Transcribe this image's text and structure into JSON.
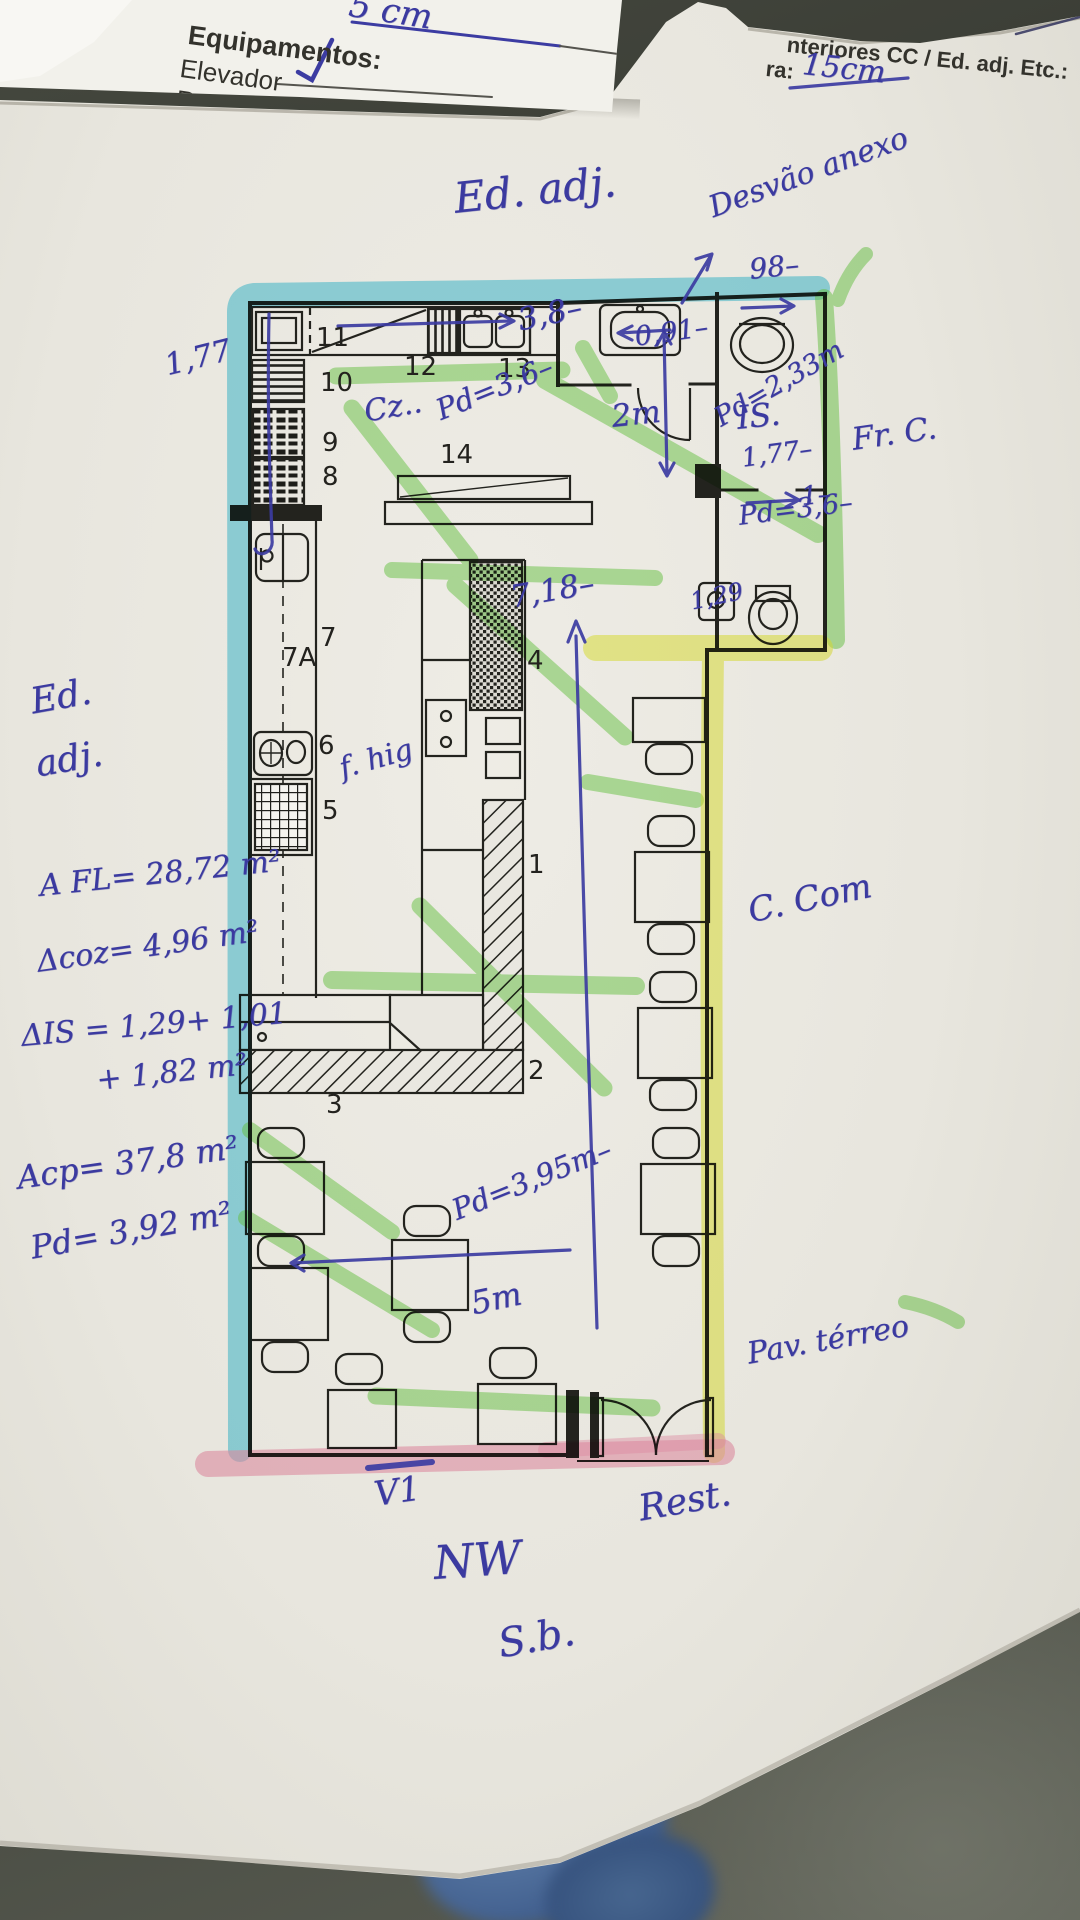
{
  "form_sheet": {
    "fragment_cm": "5 cm",
    "equipment_header": "Equipamentos:",
    "item_elevador": "Elevador",
    "item_rede": "Rede de Gá"
  },
  "plan_header": {
    "interiores_label": "nteriores CC / Ed. adj. Etc.:",
    "ra_label": "ra:",
    "ra_value": "15cm"
  },
  "plan_numbers": {
    "n1": "1",
    "n2": "2",
    "n3": "3",
    "n4": "4",
    "n5": "5",
    "n6": "6",
    "n7": "7",
    "n7a": "7A",
    "n8": "8",
    "n9": "9",
    "n10": "10",
    "n11": "11",
    "n12": "12",
    "n13": "13",
    "n14": "14"
  },
  "annotations": {
    "ed_adj_top": "Ed. adj.",
    "desvao_anexo": "Desvão anexo",
    "dim_3_8": "3,8–",
    "dim_0_91": "0,91–",
    "dim_98": "98–",
    "pd_2_33": "Pd=2,33m",
    "is_label": "IS.",
    "dim_1_77_right": "1,77–",
    "dim_2m": "2m",
    "dim_1": "1–",
    "pd_3_6_right": "Pd=3,6–",
    "dim_1_29": "1,29",
    "fr_c": "Fr. C.",
    "cz": "Cz..",
    "pd_3_6_kitchen": "Pd=3,6–",
    "dim_1_77_left": "1,77",
    "dim_7_18": "7,18–",
    "f_hig": "f. hig",
    "ed_left_1": "Ed.",
    "ed_left_2": "adj.",
    "a_fl": "A FL= 28,72 m²",
    "a_coz": "Δcoz= 4,96 m²",
    "a_is_1": "ΔIS = 1,29+ 1,01",
    "a_is_2": "+ 1,82 m²",
    "a_cp": "Acp= 37,8 m²",
    "pd_3_92": "Pd= 3,92 m²",
    "c_com": "C. Com",
    "pav_terreo": "Pav. térreo",
    "pd_3_95": "Pd=3,95m–",
    "dim_5m": "5m",
    "v1": "V1",
    "rest": "Rest.",
    "nw": "NW",
    "sb": "S.b."
  },
  "colors": {
    "pen_blue": "#3c3ca2",
    "highlight_cyan": "#2fc0de",
    "highlight_green": "#6ed24a",
    "highlight_yellow": "#e8ee3e",
    "highlight_pink": "#f29ab8"
  }
}
